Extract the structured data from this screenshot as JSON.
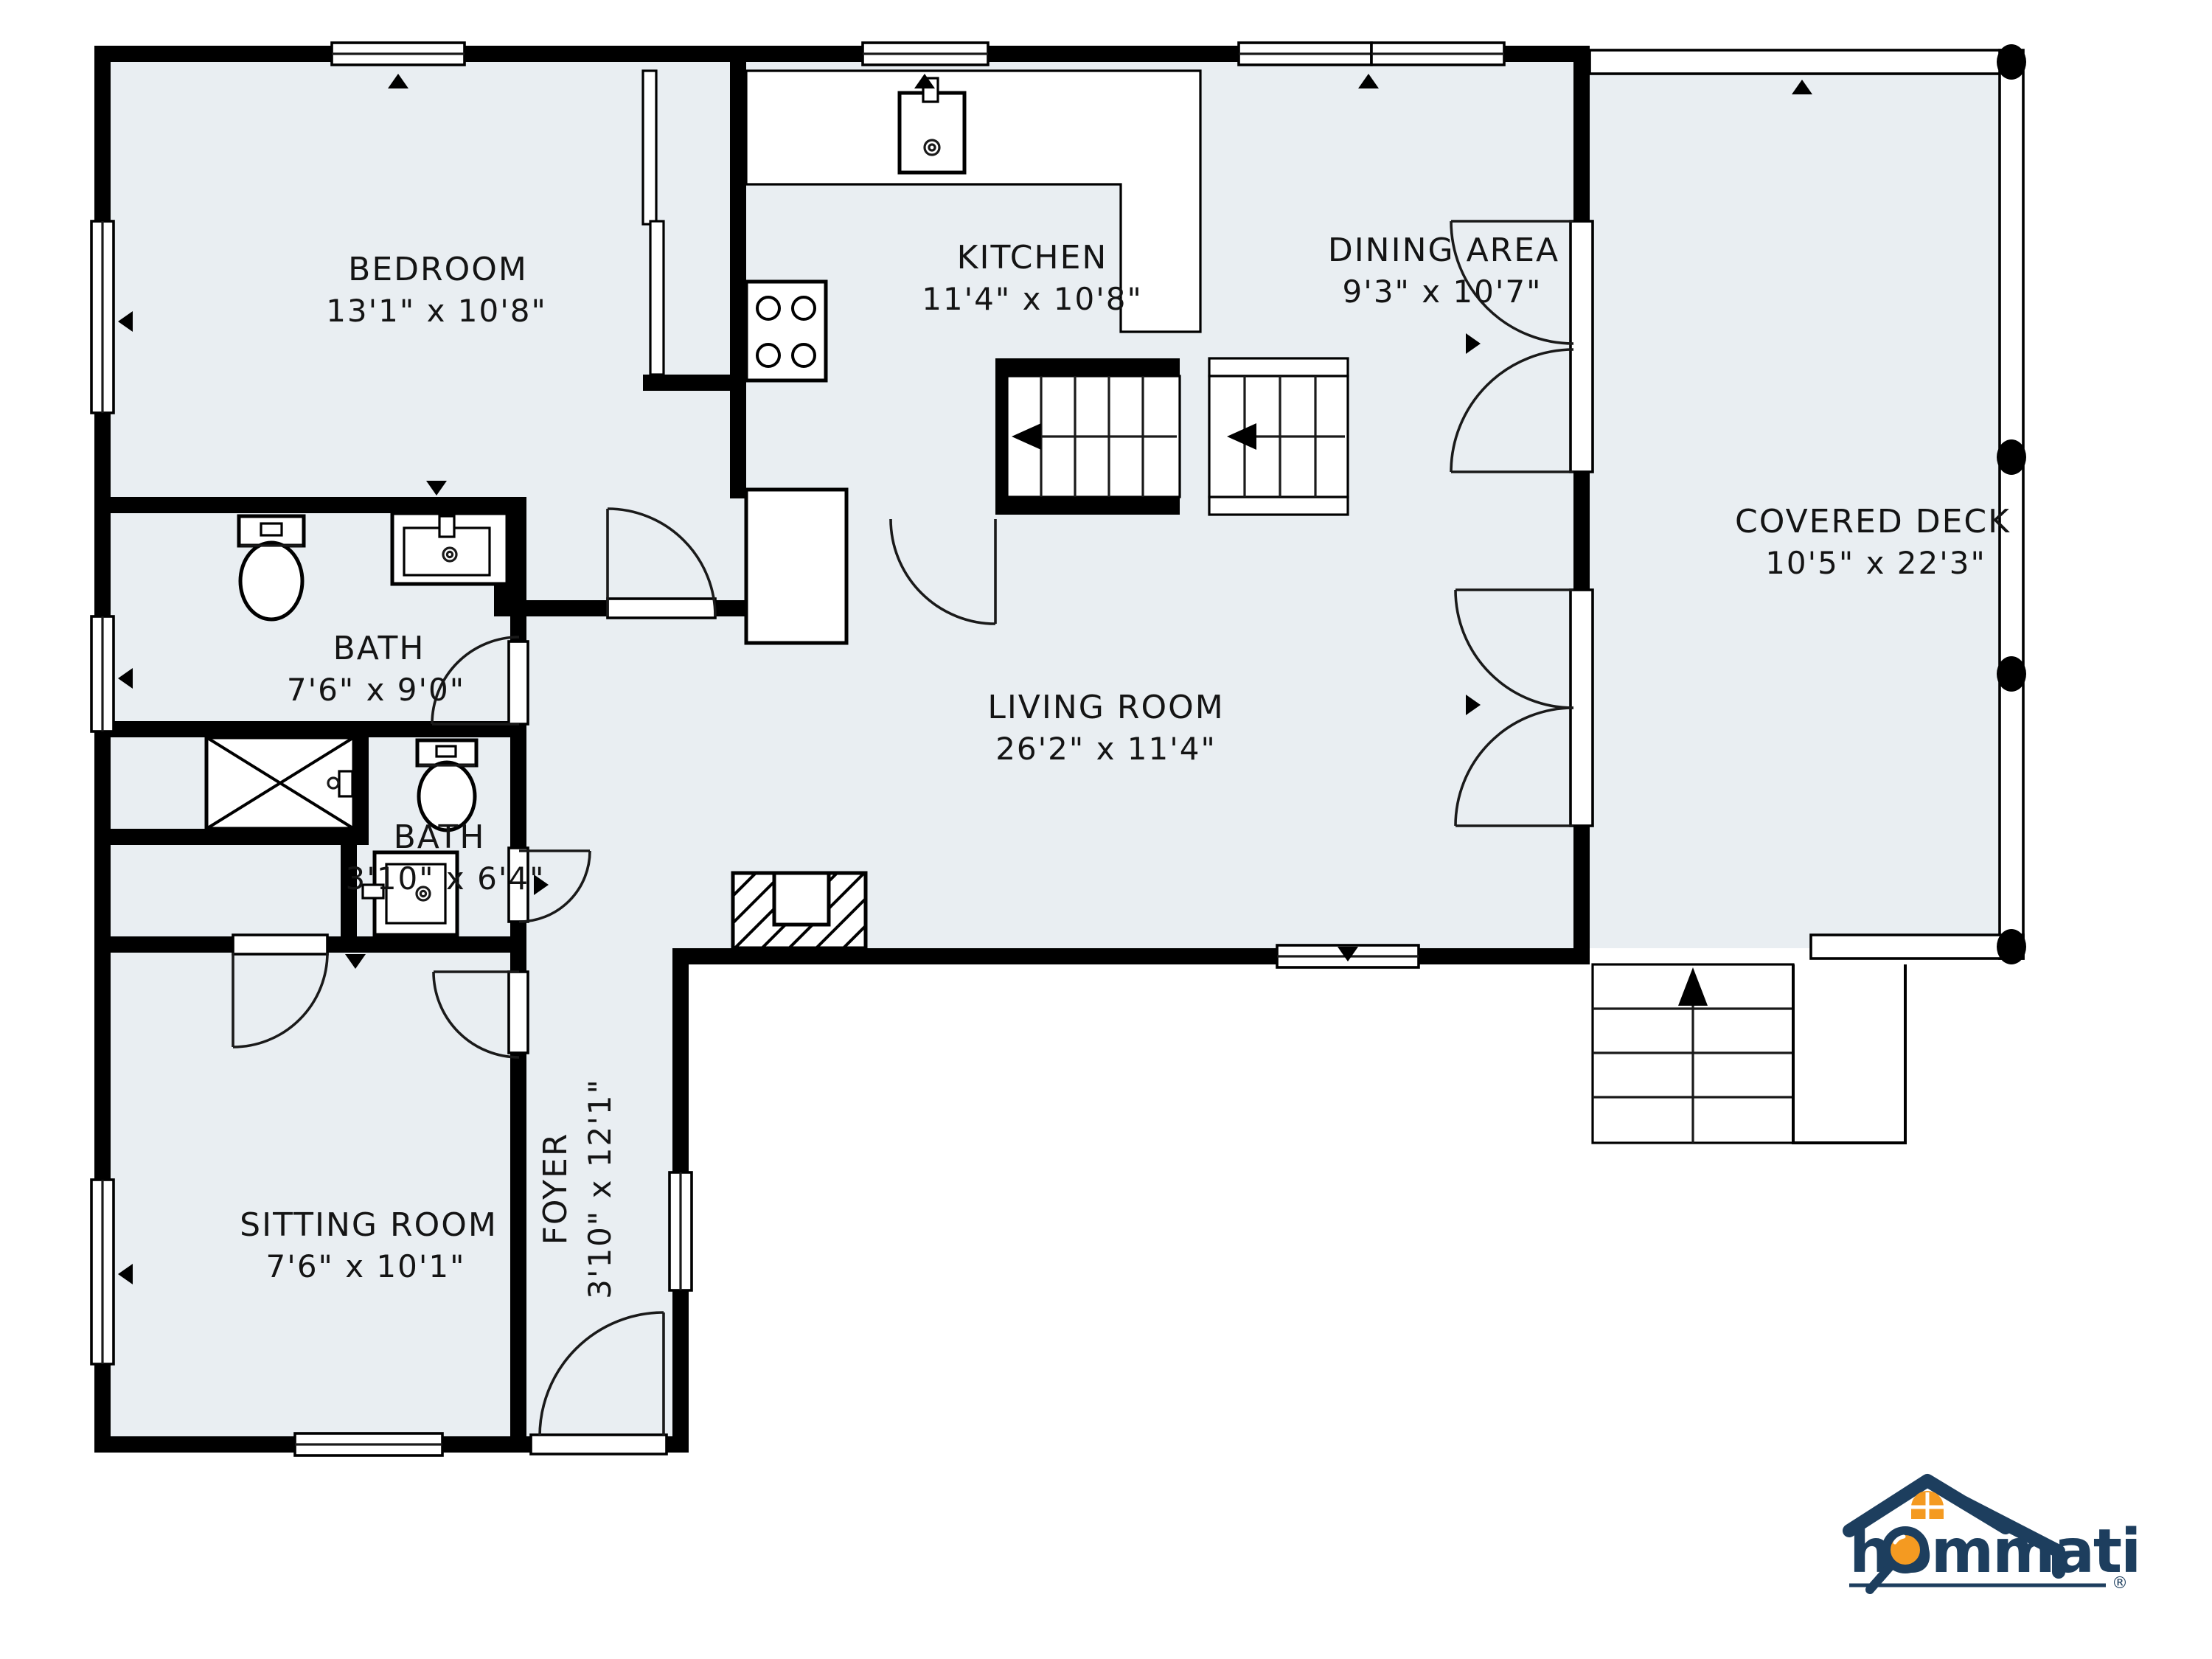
{
  "plan": {
    "rooms": [
      {
        "id": "bedroom",
        "name": "BEDROOM",
        "dims": "13'1\" x 10'8\""
      },
      {
        "id": "kitchen",
        "name": "KITCHEN",
        "dims": "11'4\" x 10'8\""
      },
      {
        "id": "dining",
        "name": "DINING AREA",
        "dims": "9'3\" x 10'7\""
      },
      {
        "id": "living",
        "name": "LIVING ROOM",
        "dims": "26'2\" x 11'4\""
      },
      {
        "id": "bath-1",
        "name": "BATH",
        "dims": "7'6\" x 9'0\""
      },
      {
        "id": "bath-2",
        "name": "BATH",
        "dims": "3'10\" x 6'4\""
      },
      {
        "id": "sitting",
        "name": "SITTING ROOM",
        "dims": "7'6\" x 10'1\""
      },
      {
        "id": "foyer",
        "name": "FOYER",
        "dims": "3'10\" x 12'1\""
      },
      {
        "id": "deck",
        "name": "COVERED DECK",
        "dims": "10'5\" x 22'3\""
      }
    ],
    "fixtures": [
      "toilet-icon",
      "sink-icon",
      "stove-icon",
      "refrigerator-icon",
      "shower-icon",
      "fireplace-icon",
      "staircase-icon",
      "deck-stairs-icon",
      "french-doors-icon",
      "window-icon",
      "door-arc-icon"
    ],
    "logo": {
      "brand": "hommati",
      "registered": "®"
    },
    "colors": {
      "floor": "#e9eef2",
      "wall": "#000000",
      "logo_navy": "#1d3e5e",
      "logo_orange": "#f49a21"
    }
  }
}
